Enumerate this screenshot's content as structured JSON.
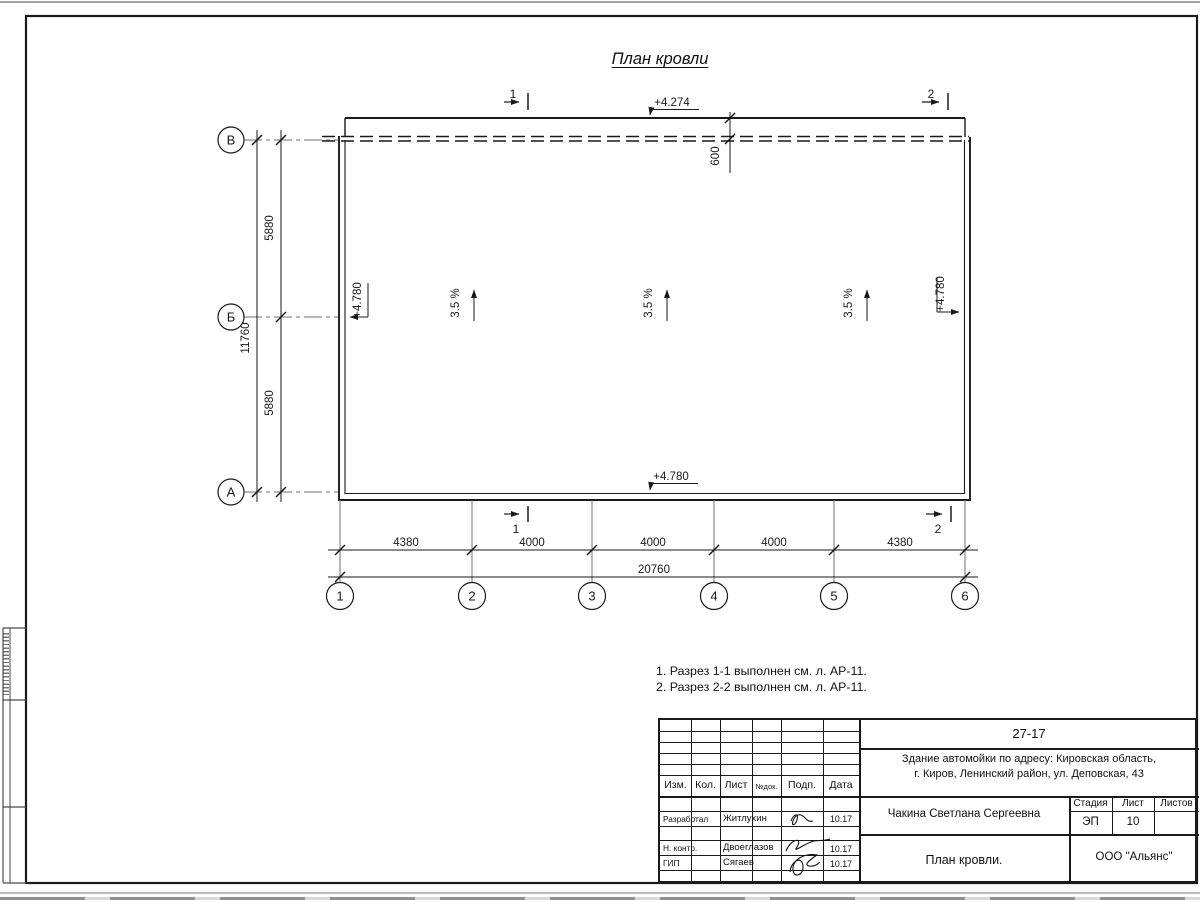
{
  "colors": {
    "line": "#1a1a1a",
    "thin_grey": "#7a7a7a"
  },
  "title": "План кровли",
  "plan": {
    "elev_top": "+4.274",
    "elev_bottom": "+4.780",
    "elev_left": "+4.780",
    "elev_right": "+4.780",
    "overhang": "600",
    "slope1": "3.5 %",
    "slope2": "3.5 %",
    "slope3": "3.5 %",
    "sec_top1": "1",
    "sec_top2": "2",
    "sec_bot1": "1",
    "sec_bot2": "2",
    "axis_rows": {
      "r1": "В",
      "r2": "Б",
      "r3": "А"
    },
    "axis_cols": {
      "c1": "1",
      "c2": "2",
      "c3": "3",
      "c4": "4",
      "c5": "5",
      "c6": "6"
    },
    "dim_v1": "5880",
    "dim_v2": "5880",
    "dim_v_total": "11760",
    "dim_h1": "4380",
    "dim_h2": "4000",
    "dim_h3": "4000",
    "dim_h4": "4000",
    "dim_h5": "4380",
    "dim_h_total": "20760"
  },
  "notes": {
    "line1": "1. Разрез 1-1 выполнен см. л. АР-11.",
    "line2": "2. Разрез 2-2 выполнен см. л. АР-11."
  },
  "titleblock": {
    "code": "27-17",
    "object_line1": "Здание автомойки по адресу: Кировская область,",
    "object_line2": "г. Киров, Ленинский район, ул. Деповская, 43",
    "col_izm": "Изм.",
    "col_kol": "Кол.",
    "col_list": "Лист",
    "col_ndoc": "№док.",
    "col_podp": "Подп.",
    "col_data": "Дата",
    "row1_role": "Разработал",
    "row1_name": "Житлухин",
    "row1_date": "10.17",
    "row2_role": "Н. контр.",
    "row2_name": "Двоеглазов",
    "row2_date": "10.17",
    "row3_role": "ГИП",
    "row3_name": "Сягаев",
    "row3_date": "10.17",
    "client": "Чакина Светлана Сергеевна",
    "doc_title": "План кровли.",
    "org": "ООО \"Альянс\"",
    "stage_label": "Стадия",
    "list_label": "Лист",
    "listov_label": "Листов",
    "stage": "ЭП",
    "list_no": "10",
    "listov": ""
  }
}
